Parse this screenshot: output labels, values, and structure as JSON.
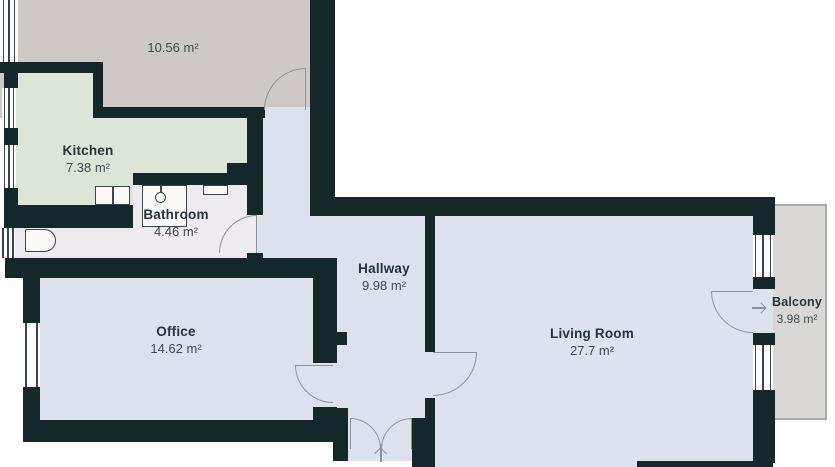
{
  "rooms": {
    "room_10_56": {
      "area": "10.56 m²"
    },
    "kitchen": {
      "name": "Kitchen",
      "area": "7.38 m²"
    },
    "bathroom": {
      "name": "Bathroom",
      "area": "4.46 m²"
    },
    "hallway": {
      "name": "Hallway",
      "area": "9.98 m²"
    },
    "office": {
      "name": "Office",
      "area": "14.62 m²"
    },
    "living_room": {
      "name": "Living Room",
      "area": "27.7 m²"
    },
    "balcony": {
      "name": "Balcony",
      "area": "3.98 m²"
    }
  },
  "colors": {
    "wall": "#142729",
    "floor_room_10_56": "#cec9c7",
    "floor_kitchen": "#dbe6d8",
    "floor_bathroom": "#edeaf0",
    "floor_hallway": "#dce2ed",
    "floor_office": "#dce2ed",
    "floor_living_room": "#dde3ee",
    "floor_balcony": "#d9d7d5",
    "balcony_border": "#a9a9a9",
    "door_swing": "#8d9499",
    "background": "#ffffff"
  }
}
